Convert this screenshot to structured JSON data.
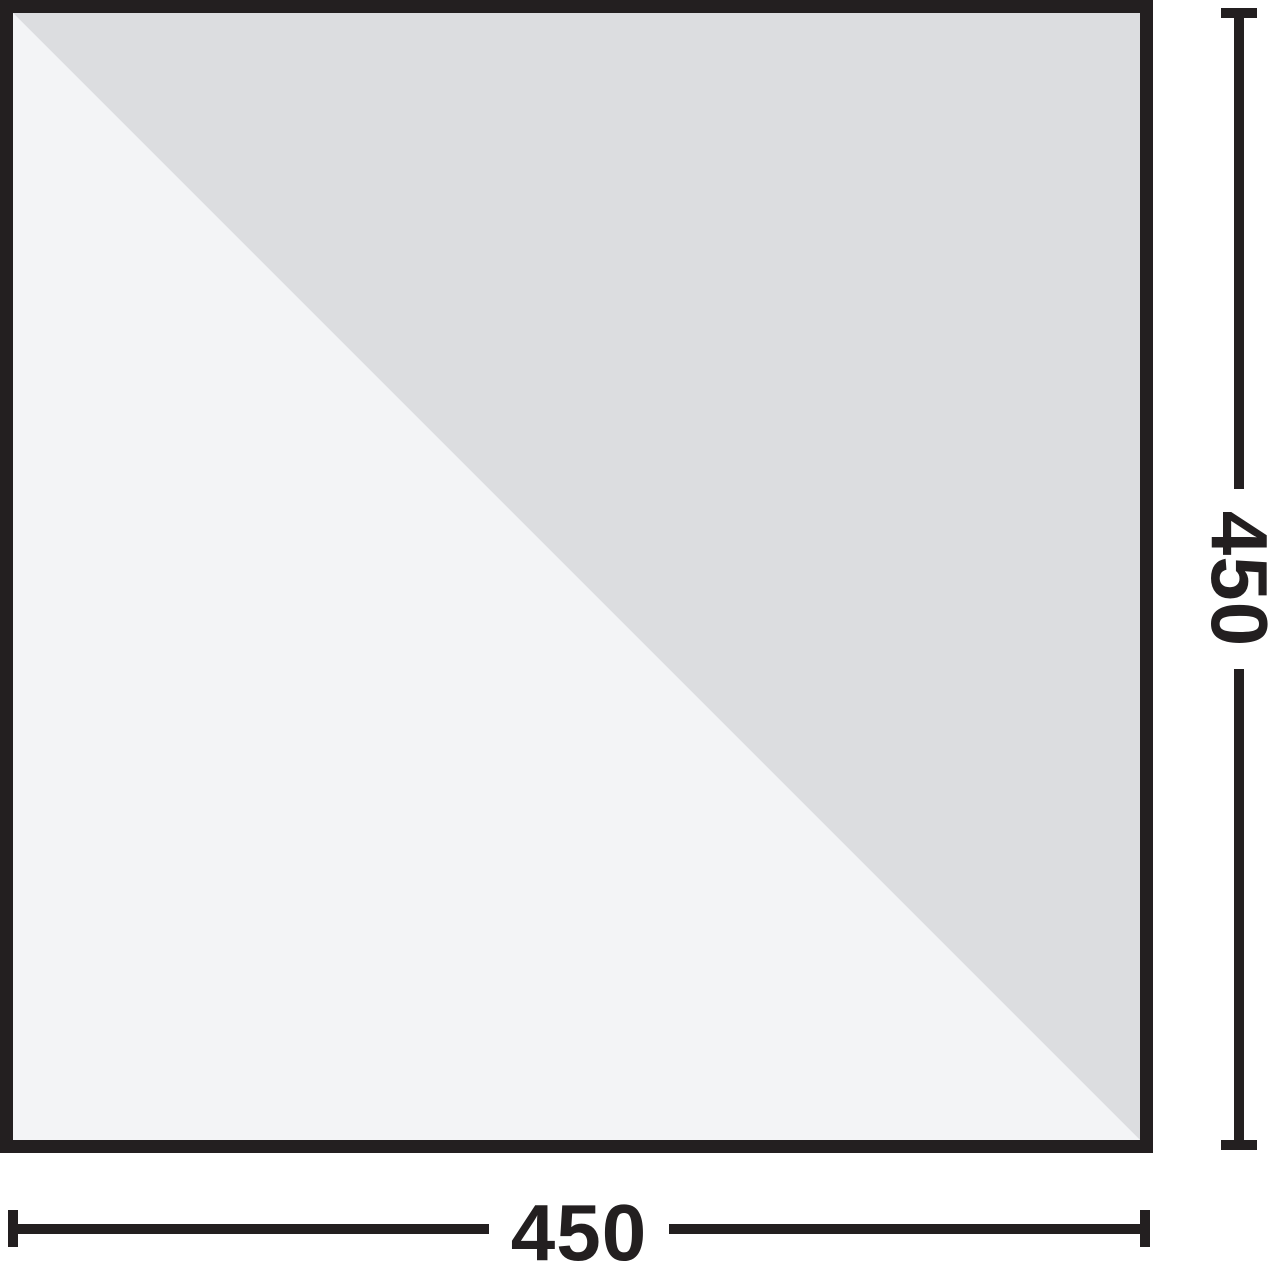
{
  "diagram": {
    "kind": "product-dimension-drawing",
    "background": "#ffffff",
    "panel": {
      "outline_color": "#231f20",
      "outline_thickness_px": 13,
      "fill_upper_right_triangle": "#dcdde0",
      "fill_lower_left_triangle": "#f3f4f6",
      "diagonal": "top-left to bottom-right"
    },
    "dimensions": {
      "width": {
        "value": "450",
        "position": "bottom",
        "orientation": "horizontal"
      },
      "height": {
        "value": "450",
        "position": "right",
        "orientation": "vertical-rotated-90deg"
      }
    }
  }
}
